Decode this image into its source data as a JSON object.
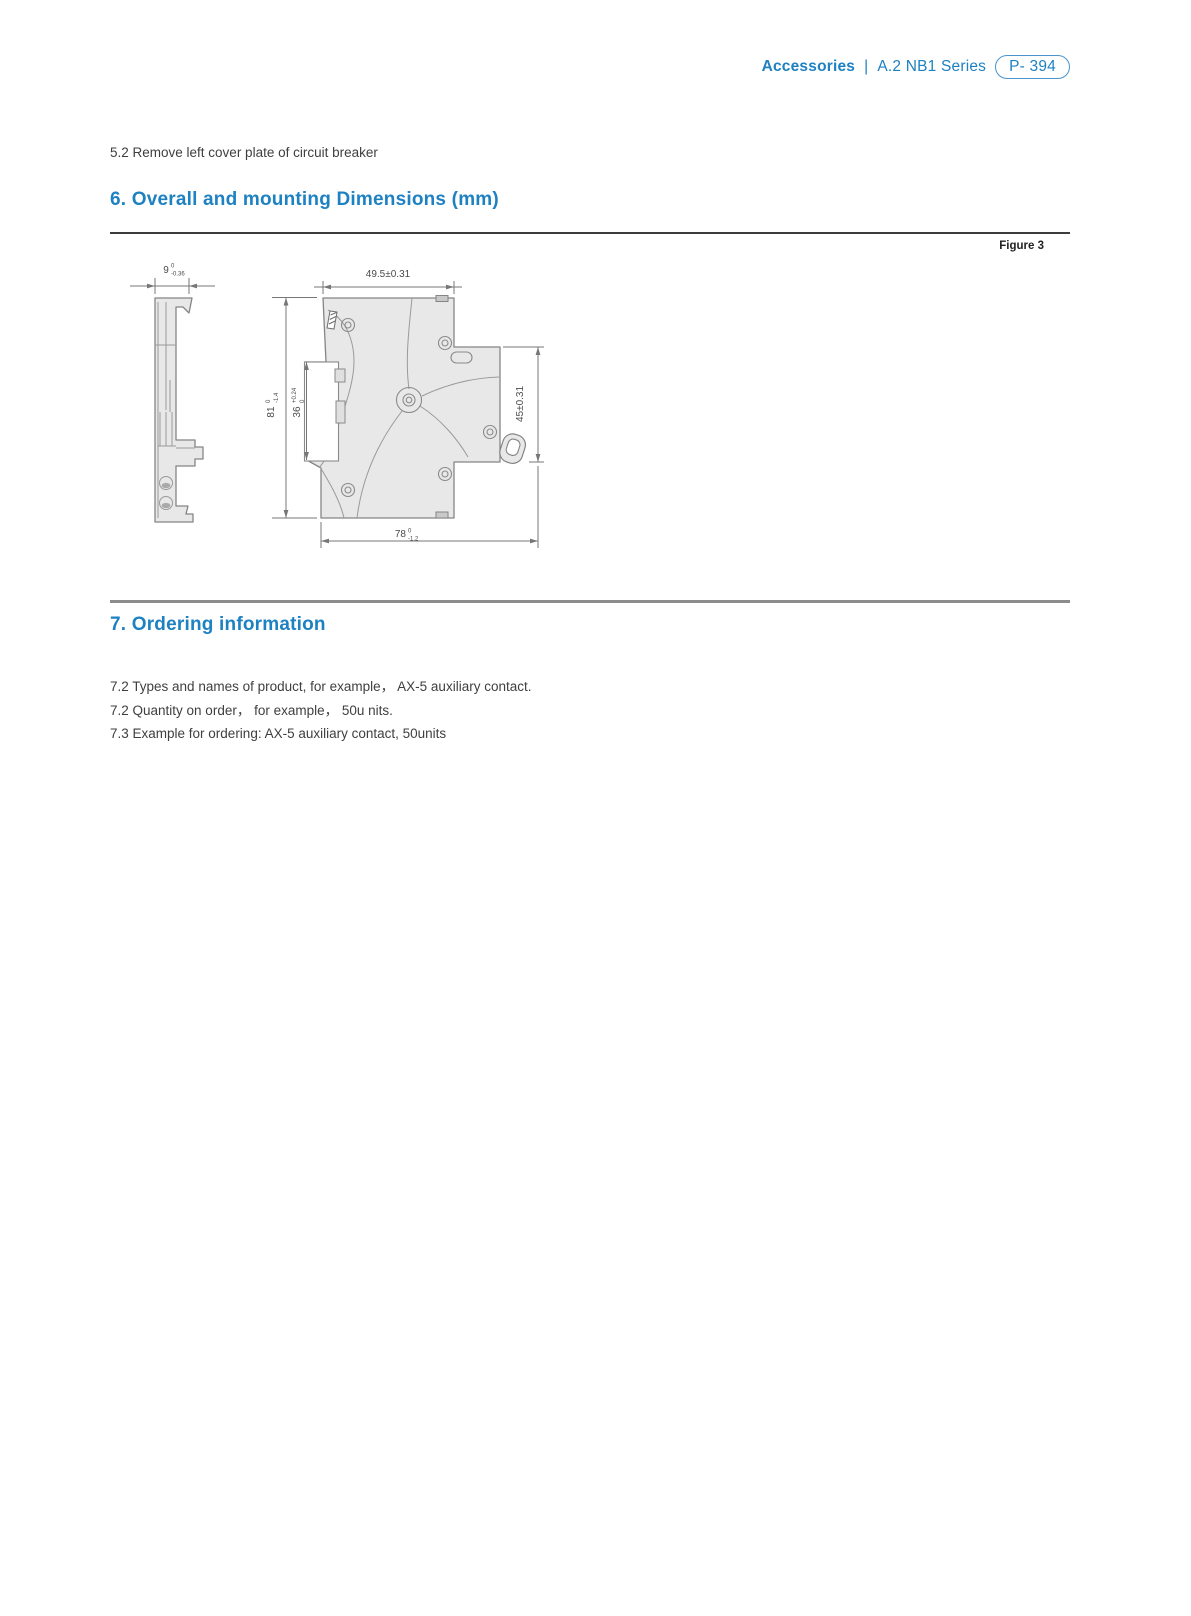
{
  "header": {
    "section": "Accessories",
    "divider": "|",
    "series": "A.2 NB1 Series",
    "page_number": "P- 394"
  },
  "note": "5.2 Remove left cover plate of circuit breaker",
  "section6": {
    "heading": "6. Overall and mounting Dimensions (mm)",
    "figure_label": "Figure 3"
  },
  "section7": {
    "heading": "7. Ordering information",
    "lines": [
      "7.2 Types and names of product, for example，  AX-5 auxiliary contact.",
      "7.2 Quantity on order，  for example，  50u nits.",
      "7.3 Example for ordering: AX-5 auxiliary contact, 50units"
    ]
  },
  "figure": {
    "dims": {
      "side_width": {
        "nominal": "9",
        "upper": "0",
        "lower": "-0.36"
      },
      "overall_width": "49.5±0.31",
      "overall_height": {
        "nominal": "81",
        "upper": "0",
        "lower": "-1.4"
      },
      "din_recess": {
        "nominal": "36",
        "upper": "+0.24",
        "lower": "0"
      },
      "step_height": "45±0.31",
      "base_width": {
        "nominal": "78",
        "upper": "0",
        "lower": "-1.2"
      }
    }
  },
  "colors": {
    "accent_blue": "#1d81c2",
    "body_text": "#3f3f3f",
    "drawing_line": "#8a8a8a",
    "drawing_fill": "#e8e8e8"
  }
}
